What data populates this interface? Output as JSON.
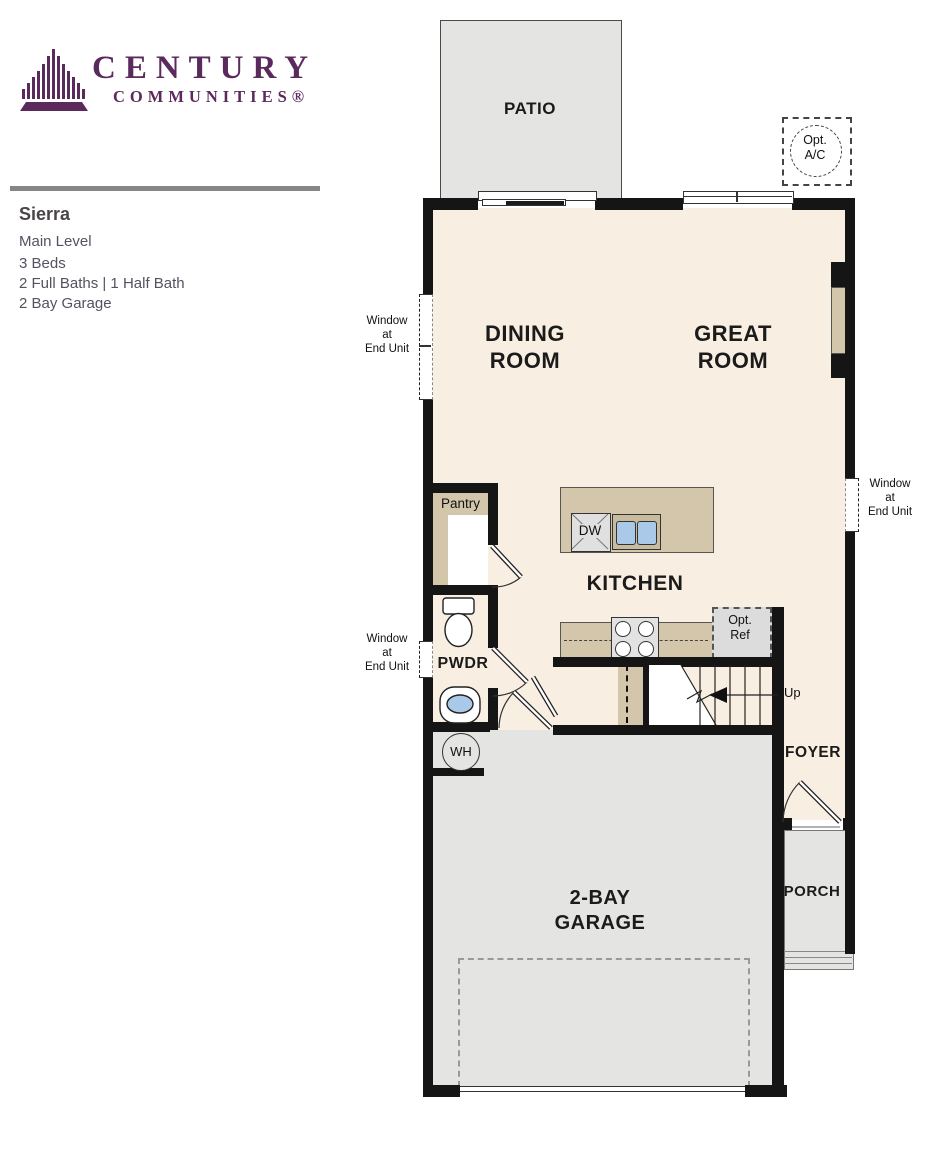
{
  "brand": {
    "line1": "CENTURY",
    "line2": "COMMUNITIES®"
  },
  "plan": {
    "name": "Sierra",
    "level": "Main Level",
    "details": [
      "3 Beds",
      "2 Full Baths | 1 Half Bath",
      "2 Bay Garage"
    ]
  },
  "rooms": {
    "patio": "PATIO",
    "dining": [
      "DINING",
      "ROOM"
    ],
    "great": [
      "GREAT",
      "ROOM"
    ],
    "kitchen": "KITCHEN",
    "pantry": "Pantry",
    "pwdr": "PWDR",
    "foyer": "FOYER",
    "porch": "PORCH",
    "garage": [
      "2-BAY",
      "GARAGE"
    ]
  },
  "annotations": {
    "window_end_unit": [
      "Window",
      "at",
      "End Unit"
    ],
    "opt_ac": [
      "Opt.",
      "A/C"
    ],
    "opt_ref": [
      "Opt.",
      "Ref"
    ],
    "up": "Up",
    "dw": "DW",
    "wh": "WH"
  },
  "colors": {
    "brand_purple": "#5b2a5d",
    "floor_cream": "#f8efe2",
    "hardscape_gray": "#e4e4e2",
    "cabinet_tan": "#d3c6aa",
    "fixture_blue": "#aac9e8",
    "wall_black": "#151515",
    "divider_gray": "#868686",
    "text_gray": "#56525e"
  }
}
